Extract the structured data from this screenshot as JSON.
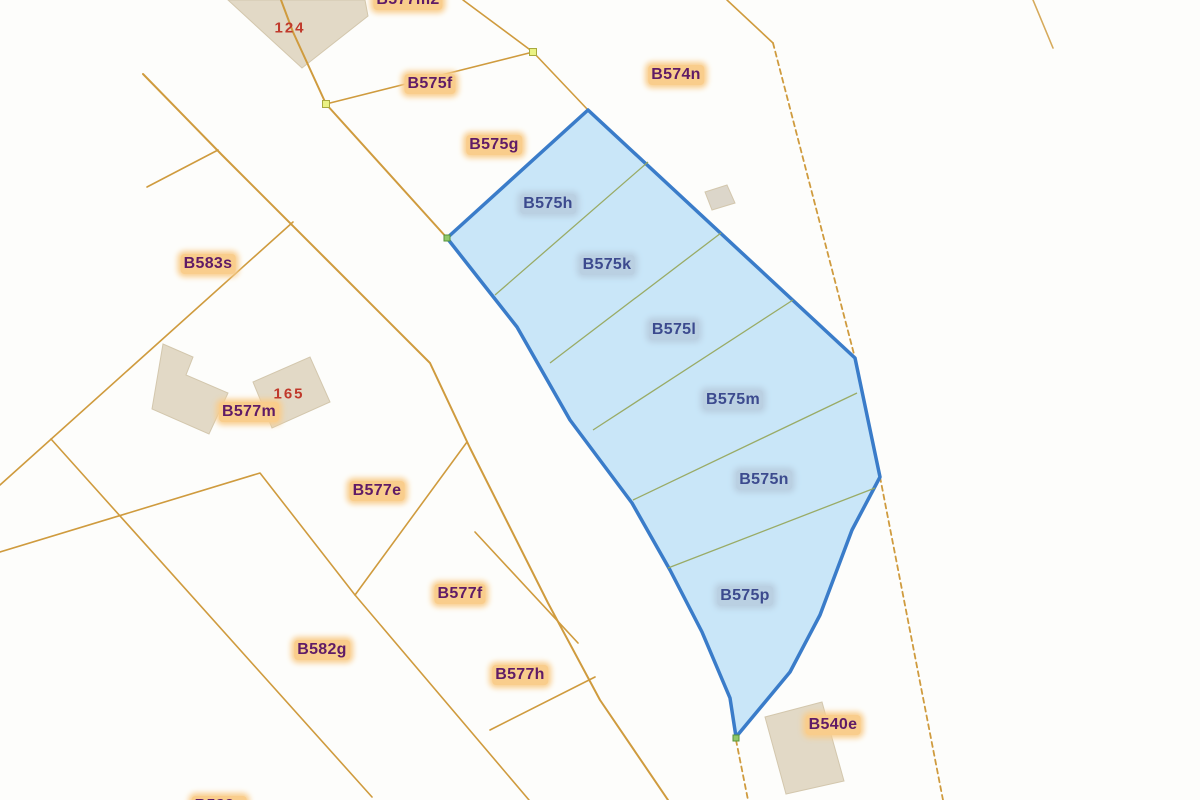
{
  "labels": {
    "b577m2_partial": "B577m2",
    "b575f": "B575f",
    "b574n": "B574n",
    "b575g": "B575g",
    "b583s": "B583s",
    "b577m": "B577m",
    "b577e": "B577e",
    "b577f": "B577f",
    "b582g": "B582g",
    "b577h": "B577h",
    "b540e": "B540e",
    "b582_partial": "B582e"
  },
  "selected_parcels": {
    "b575h": "B575h",
    "b575k": "B575k",
    "b575l": "B575l",
    "b575m": "B575m",
    "b575n": "B575n",
    "b575p": "B575p"
  },
  "house_numbers": {
    "n124": "124",
    "n165": "165"
  },
  "colors": {
    "boundary_line": "#cf9b3e",
    "selection_fill": "#bfe2f7",
    "selection_border": "#3a7cc9",
    "subdivision_line": "#97a85e",
    "parcel_label_text": "#5f1b66",
    "parcel_label_halo": "#f9cd8c",
    "selected_label_text": "#3c4a8e",
    "selected_label_halo": "#bad0e2",
    "house_number_text": "#c0392b",
    "building_fill": "#e2d9c6",
    "vertex_marker": "#eaf283"
  }
}
